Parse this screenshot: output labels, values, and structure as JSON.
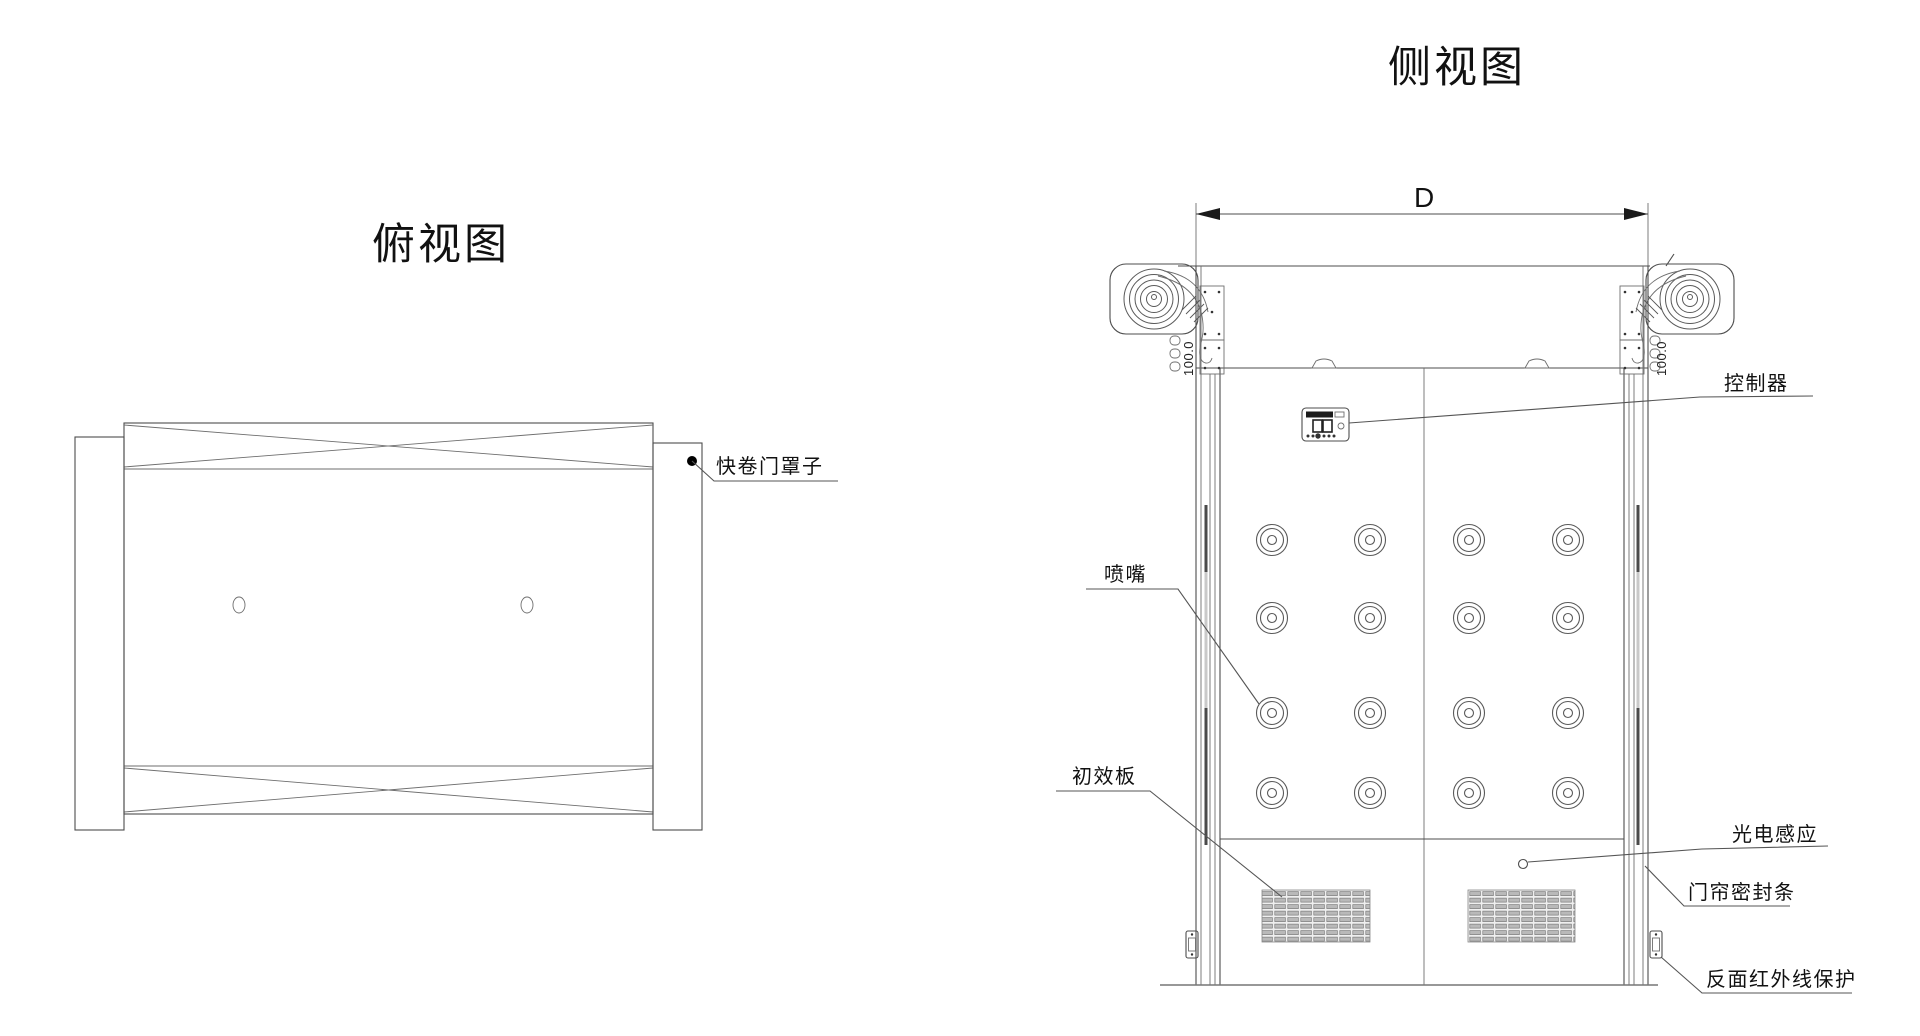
{
  "titles": {
    "top_view": "俯视图",
    "side_view": "侧视图"
  },
  "dimensions": {
    "width_label": "D",
    "rail_left": "100.0",
    "rail_right": "100.0"
  },
  "callouts": {
    "door_cover": "快卷门罩子",
    "controller": "控制器",
    "nozzle": "喷嘴",
    "primary_filter": "初效板",
    "photo_sensor": "光电感应",
    "curtain_seal": "门帘密封条",
    "rear_infrared": "反面红外线保护"
  },
  "colors": {
    "background": "#ffffff",
    "line": "#4d4d4d",
    "line_light": "#8a8a8a",
    "text": "#111111",
    "grille_fill": "#b9b9b9"
  }
}
